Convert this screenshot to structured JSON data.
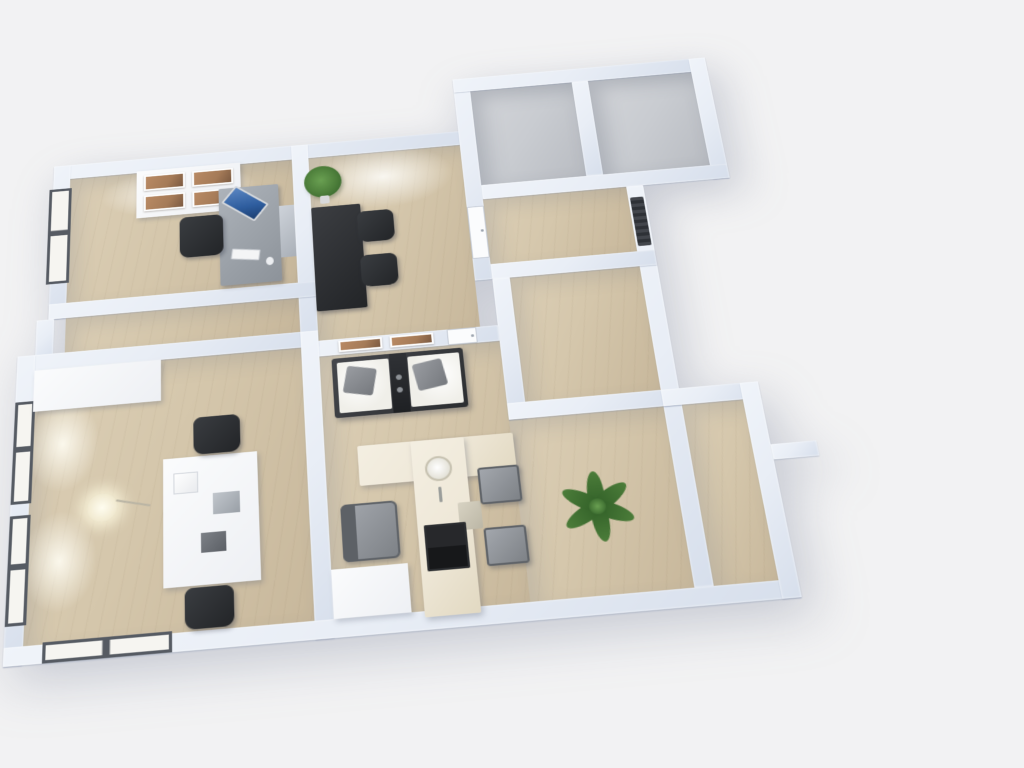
{
  "meta": {
    "view": "3d-floor-plan-birdseye-render",
    "description": "Rendered bird's-eye 3D floor plan of an apartment with office rooms, living-kitchen area, hallway, closets and corridor. No visible UI text."
  },
  "colors": {
    "background": "#f2f2f3",
    "wall": "#e9eef6",
    "wallShade": "#d7dfec",
    "woodFloor": "#d5c7ac",
    "woodLight": "#dccfb6",
    "woodDark": "#c8b89c",
    "grayFloor": "#c9ccd1",
    "windowFrame": "#565b63",
    "windowPane": "#f6f5f1",
    "creamCounter": "#efe8d8",
    "plantGreen": "#4c7d3a",
    "screenBlue": "#2e5d9e",
    "artBrown": "#a57b58"
  },
  "rooms": {
    "office": {
      "label": "Office room with desk, monitor, chair, wall art and window"
    },
    "study": {
      "label": "Study room with black desk, two chairs and potted plant"
    },
    "closetA": {
      "label": "Empty closet room with gray floor"
    },
    "closetB": {
      "label": "Empty closet room with gray floor, protruding block"
    },
    "hallway": {
      "label": "Hallway with white door and radiator"
    },
    "midright": {
      "label": "Empty room with wooden floor"
    },
    "living": {
      "label": "Living room and kitchen with sofa, island, chairs and large plant"
    },
    "bedroom": {
      "label": "Room with windows, floor lamp, white table and two chairs"
    },
    "corridor": {
      "label": "Narrow corridor with wooden floor"
    }
  },
  "furniture": {
    "sofa": {
      "label": "White two-seat sofa with gray pillows and dark console"
    },
    "island": {
      "label": "Cream kitchen island with sink and cooktop"
    },
    "armchair": {
      "label": "Gray armchair"
    },
    "diningChairs": {
      "label": "Two gray dining chairs"
    },
    "bigPlant": {
      "label": "Large green plant"
    },
    "smallPlant": {
      "label": "Potted plant"
    },
    "officeDesk": {
      "label": "Desk with monitor and keyboard"
    },
    "wallArt": {
      "label": "Panel with four framed pictures"
    },
    "floorLamp": {
      "label": "Floor lamp"
    },
    "whiteTable": {
      "label": "White table with lamp and accessories"
    },
    "wardrobe": {
      "label": "White wardrobe"
    }
  }
}
